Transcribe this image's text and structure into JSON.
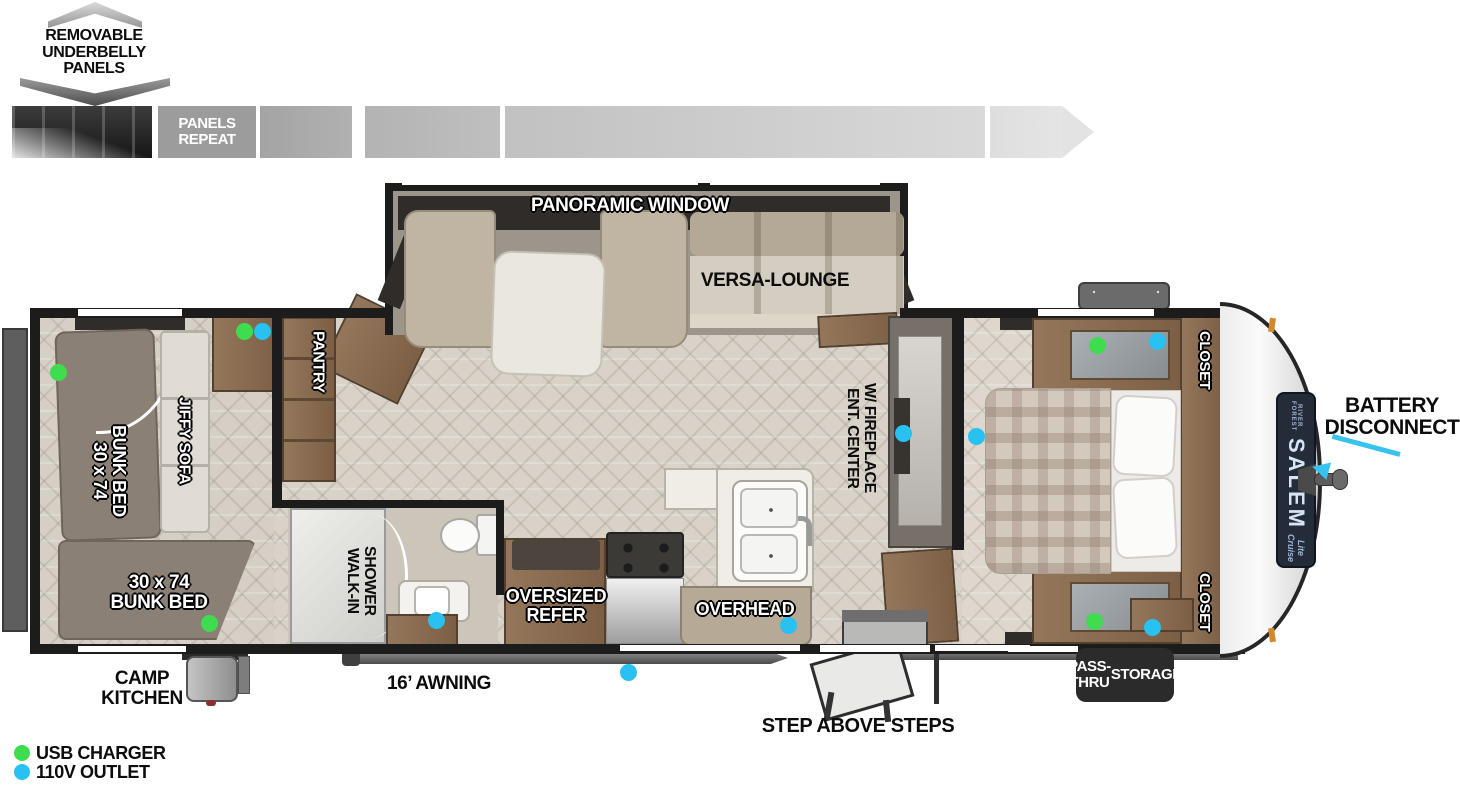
{
  "top_graphic": {
    "title": "REMOVABLE UNDERBELLY PANELS",
    "repeat": "PANELS REPEAT"
  },
  "rooms": {
    "panoramic_window": "PANORAMIC WINDOW",
    "versa_lounge": "VERSA-LOUNGE",
    "pantry": "PANTRY",
    "jiffy_sofa": "JIFFY SOFA",
    "bunk_side": {
      "size": "30 x 74",
      "name": "BUNK BED"
    },
    "bunk_rear": {
      "size": "30 x 74",
      "name": "BUNK BED"
    },
    "shower": {
      "line1": "WALK-IN",
      "line2": "SHOWER"
    },
    "refer": {
      "line1": "OVERSIZED",
      "line2": "REFER"
    },
    "overhead": "OVERHEAD",
    "ent_center": {
      "line1": "ENT. CENTER",
      "line2": "W/ FIREPLACE"
    },
    "closet_top": "CLOSET",
    "closet_bottom": "CLOSET"
  },
  "exterior": {
    "camp_kitchen": {
      "line1": "CAMP",
      "line2": "KITCHEN"
    },
    "awning": "16’ AWNING",
    "steps": "STEP ABOVE STEPS",
    "pass_thru": {
      "line1": "PASS-THRU",
      "line2": "STORAGE"
    },
    "battery": {
      "line1": "BATTERY",
      "line2": "DISCONNECT"
    }
  },
  "branding": {
    "maker": "FOREST RIVER",
    "model": "SALEM",
    "series": "Cruise Lite"
  },
  "legend": {
    "usb": {
      "label": "USB CHARGER",
      "color": "#3fdc4f"
    },
    "outlet": {
      "label": "110V OUTLET",
      "color": "#29c1f0"
    }
  },
  "outlets": [
    {
      "type": "usb",
      "x": 58,
      "y": 372
    },
    {
      "type": "usb",
      "x": 244,
      "y": 331
    },
    {
      "type": "outlet",
      "x": 262,
      "y": 331
    },
    {
      "type": "usb",
      "x": 209,
      "y": 623
    },
    {
      "type": "outlet",
      "x": 436,
      "y": 620
    },
    {
      "type": "outlet",
      "x": 628,
      "y": 672
    },
    {
      "type": "outlet",
      "x": 788,
      "y": 625
    },
    {
      "type": "outlet",
      "x": 903,
      "y": 433
    },
    {
      "type": "outlet",
      "x": 976,
      "y": 436
    },
    {
      "type": "usb",
      "x": 1097,
      "y": 345
    },
    {
      "type": "outlet",
      "x": 1157,
      "y": 341
    },
    {
      "type": "usb",
      "x": 1094,
      "y": 621
    },
    {
      "type": "outlet",
      "x": 1152,
      "y": 627
    }
  ]
}
